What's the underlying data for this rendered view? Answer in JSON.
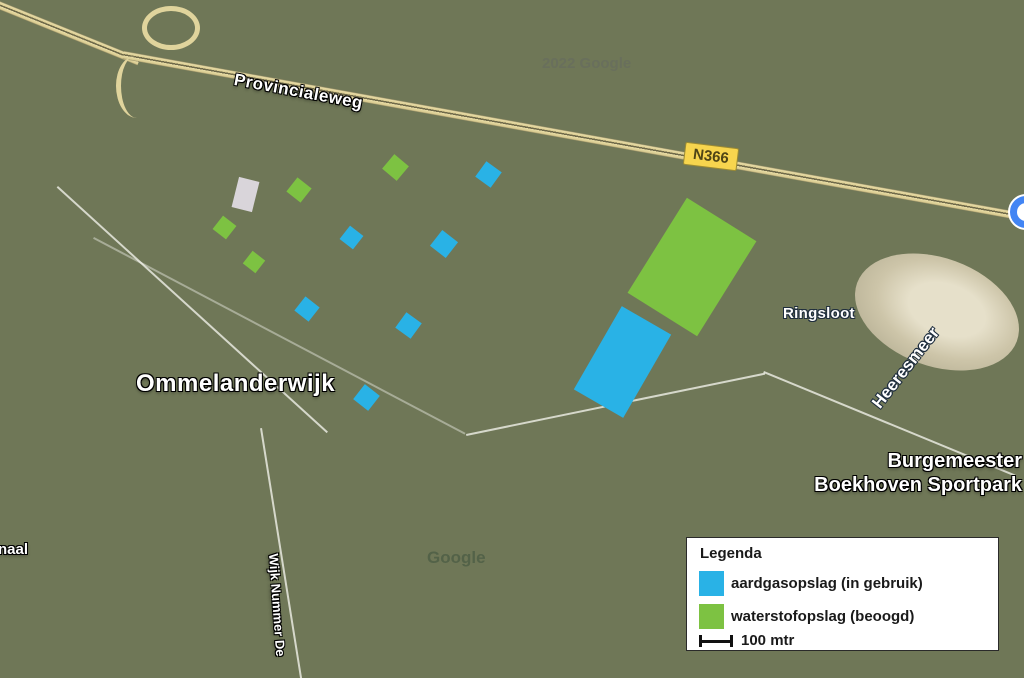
{
  "map": {
    "place_labels": {
      "road_name": "Provincialeweg",
      "road_shield": "N366",
      "town": "Ommelanderwijk",
      "waterway": "Ringsloot",
      "lake": "Heeresmeer",
      "sportpark_line1": "Burgemeester",
      "sportpark_line2": "Boekhoven Sportpark",
      "canal_partial": "naal",
      "street_vertical": "Wijk Nummer De",
      "watermark_top": "2022 Google",
      "watermark_bottom": "Google"
    },
    "colors": {
      "gas_blue": "#29b2e6",
      "hydrogen_green": "#7dc242",
      "unknown_gray": "#d9d5da",
      "road_yellow": "#e8dca6",
      "shield_yellow": "#f7d54e",
      "poi_blue": "#4285f4"
    },
    "marker_colors": {
      "gas": "#29b2e6",
      "hydrogen": "#7dc242",
      "unknown": "#d9d5da"
    },
    "markers": [
      {
        "kind": "unknown",
        "cx": 245,
        "cy": 194,
        "w": 21,
        "h": 31,
        "rot": 14
      },
      {
        "kind": "hydrogen",
        "cx": 299,
        "cy": 190,
        "w": 18,
        "h": 18,
        "rot": 38
      },
      {
        "kind": "hydrogen",
        "cx": 224,
        "cy": 227,
        "w": 17,
        "h": 17,
        "rot": 38
      },
      {
        "kind": "hydrogen",
        "cx": 254,
        "cy": 262,
        "w": 16,
        "h": 16,
        "rot": 38
      },
      {
        "kind": "hydrogen",
        "cx": 395,
        "cy": 167,
        "w": 19,
        "h": 19,
        "rot": 40
      },
      {
        "kind": "gas",
        "cx": 351,
        "cy": 237,
        "w": 17,
        "h": 17,
        "rot": 38
      },
      {
        "kind": "gas",
        "cx": 488,
        "cy": 174,
        "w": 19,
        "h": 19,
        "rot": 36
      },
      {
        "kind": "gas",
        "cx": 444,
        "cy": 244,
        "w": 20,
        "h": 20,
        "rot": 38
      },
      {
        "kind": "gas",
        "cx": 307,
        "cy": 309,
        "w": 18,
        "h": 18,
        "rot": 38
      },
      {
        "kind": "gas",
        "cx": 408,
        "cy": 325,
        "w": 19,
        "h": 19,
        "rot": 36
      },
      {
        "kind": "gas",
        "cx": 366,
        "cy": 397,
        "w": 19,
        "h": 19,
        "rot": 38
      },
      {
        "kind": "hydrogen",
        "cx": 692,
        "cy": 267,
        "w": 82,
        "h": 112,
        "rot": 32
      },
      {
        "kind": "gas",
        "cx": 622,
        "cy": 362,
        "w": 57,
        "h": 96,
        "rot": 30
      }
    ]
  },
  "legend": {
    "title": "Legenda",
    "items": [
      {
        "label": "aardgasopslag (in gebruik)",
        "color": "#29b2e6"
      },
      {
        "label": "waterstofopslag (beoogd)",
        "color": "#7dc242"
      }
    ],
    "scale_label": "100 mtr"
  }
}
